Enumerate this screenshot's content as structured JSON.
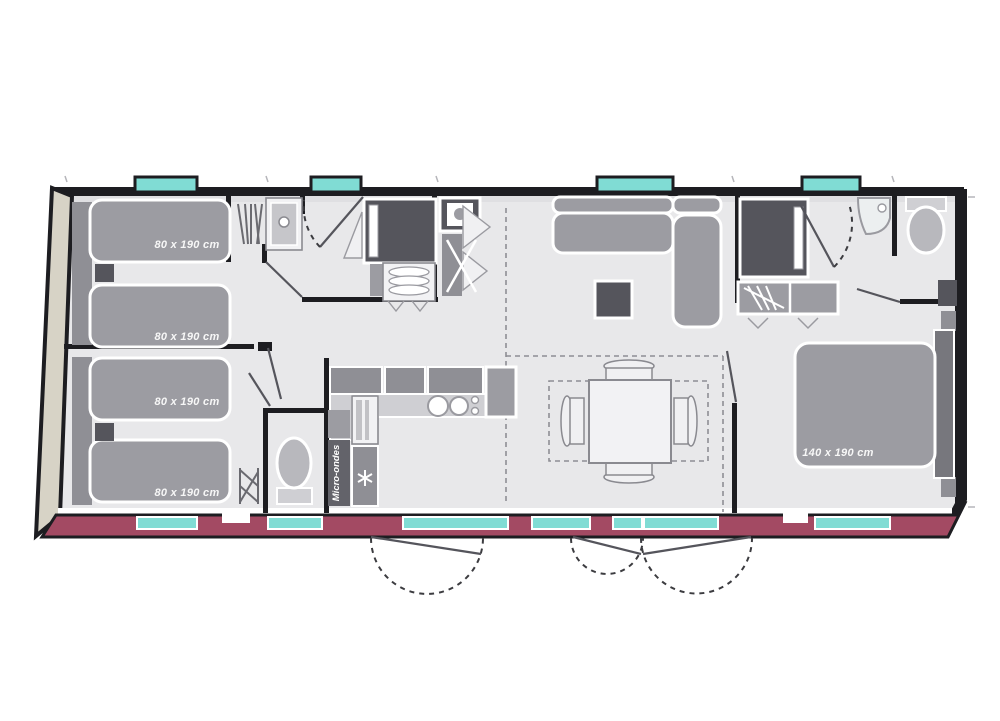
{
  "floorplan": {
    "type": "mobile-home floor plan, top view with slight 3D edge",
    "bedroom1": {
      "bed1_label": "80 x 190 cm",
      "bed2_label": "80 x 190 cm"
    },
    "bedroom2": {
      "bed1_label": "80 x 190 cm",
      "bed2_label": "80 x 190 cm"
    },
    "master_bedroom": {
      "bed_label": "140 x 190 cm"
    },
    "kitchen": {
      "microwave_label": "Micro-ondes"
    },
    "colors": {
      "outer_wall": "#1d1d21",
      "floor": "#e8e8ea",
      "terrace_wall": "#a34a63",
      "window_glass": "#80dcd4",
      "side_wall_3d": "#d7d3c6",
      "furniture_gray": "#9c9ca2",
      "furniture_dark": "#55555c",
      "label_text": "#f7f7f7"
    }
  }
}
